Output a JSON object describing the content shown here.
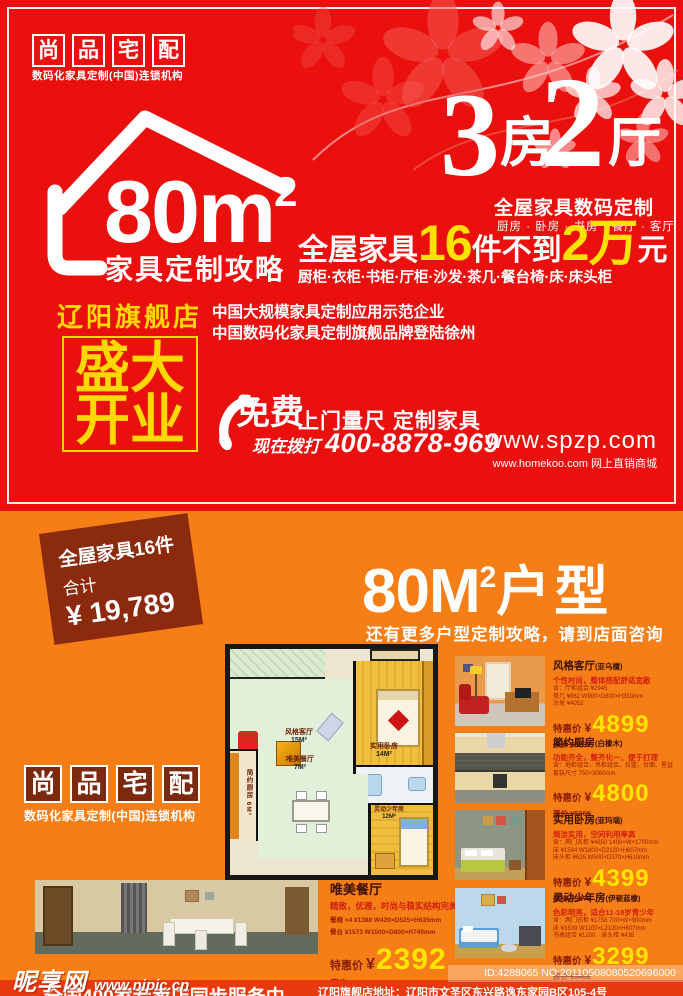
{
  "colors": {
    "red": "#e9100e",
    "orange": "#f57e17",
    "yellow": "#ffe100",
    "ribbon_brown": "#8c2a0e",
    "logo_box_brown": "#7b2a10",
    "gold": "#ffd800"
  },
  "icons": {
    "house": "house-outline-icon",
    "phone": "telephone-handset-icon",
    "flowers": "flower-blossom-decoration"
  },
  "brand": {
    "c0": "尚",
    "c1": "品",
    "c2": "宅",
    "c3": "配",
    "tagline": "数码化家具定制(中国)连锁机构"
  },
  "hero": {
    "area_num": "80m",
    "area_sup": "2",
    "area_caption": "家具定制攻略",
    "big3": "3",
    "fang": "房",
    "big2": "2",
    "ting": "厅",
    "subtitle": "全屋家具数码定制",
    "room_list": "厨房 · 卧房 · 书房 · 餐厅 · 客厅",
    "offer_p1": "全屋家具",
    "offer_n1": "16",
    "offer_p2": "件不到",
    "offer_n2": "2万",
    "offer_p3": "元",
    "furniture_list": "厨柜·衣柜·书柜·厅柜·沙发·茶几·餐台椅·床·床头柜",
    "store_name": "辽阳旗舰店",
    "opening_l1": "盛大",
    "opening_l2": "开业",
    "cred1": "中国大规模家具定制应用示范企业",
    "cred2": "中国数码化家具定制旗舰品牌登陆徐州",
    "cta_free": "免费",
    "cta_rest": "上门量尺 定制家具",
    "call_prefix": "现在拨打",
    "phone": "400-8878-969",
    "site_main": "www.spzp.com",
    "site_sub": "www.homekoo.com 网上直销商城"
  },
  "promo": {
    "ribbon_l1": "全屋家具16件",
    "ribbon_l2": "合计",
    "ribbon_price": "¥ 19,789",
    "title_num": "80M",
    "title_sup": "2",
    "title_suffix": "户型",
    "subtitle": "还有更多户型定制攻略，请到店面咨询"
  },
  "floorplan": {
    "living_name": "风格客厅",
    "living_size": "15M²",
    "bedroom_name": "实用卧房",
    "bedroom_size": "14M²",
    "kitchen_name": "简约厨房 6M²",
    "dining_name": "唯美餐厅",
    "dining_size": "7M²",
    "youth_name": "灵动少年房",
    "youth_size": "12M²"
  },
  "featured": {
    "title": "唯美餐厅",
    "desc": "精致，优雅，时尚与稳实结构完美结合",
    "spec1": "餐椅 ×4 ¥1388 W420×D525×H635mm",
    "spec2": "餐台 ¥1573 W1500×D800×H740mm",
    "price_label": "特惠价",
    "currency": "¥",
    "price": "2392",
    "orig": "原价 ¥2961"
  },
  "products": [
    {
      "title": "风格客厅",
      "variant": "(亚乌檀)",
      "desc": "个性时尚，整体搭配舒适宽敞",
      "spec1": "含：厅柜组合 ¥2945",
      "spec2": "茶几 ¥862 W900×D800×H350mm",
      "spec3": "沙发 ¥4052",
      "price_label": "特惠价",
      "currency": "¥",
      "price": "4899",
      "orig": "原价 ¥5299"
    },
    {
      "title": "简约厨房",
      "variant": "(白橡木)",
      "desc": "功能齐全，整齐化一，便于打理",
      "spec1": "含：地柜组合、吊柜组合、拉篮、台面、星盆",
      "spec2": "套装尺寸 750×3060mm",
      "spec3": "",
      "price_label": "特惠价",
      "currency": "¥",
      "price": "4800",
      "orig": "原价 ¥5365"
    },
    {
      "title": "实用卧房",
      "variant": "(亚玛瑙)",
      "desc": "简洁实用，空间利用率高",
      "spec1": "含：两门衣柜 ¥4650 1400×W×1700mm",
      "spec2": "床 ¥1594 W1800×D2120×H607mm",
      "spec3": "床头柜 ¥635 W500×D370×H610mm",
      "price_label": "特惠价",
      "currency": "¥",
      "price": "4399",
      "orig": "原价 ¥5479"
    },
    {
      "title": "灵动少年房",
      "variant": "(伊顿蓝橡)",
      "desc": "色彩明亮，适合11-18岁青少年",
      "spec1": "含：两门衣柜 ¥1758 700×W×900mm",
      "spec2": "床 ¥1639 W1100×L2120×H607mm",
      "spec3": "书桌组合 ¥1200　床头柜 ¥435",
      "price_label": "特惠价",
      "currency": "¥",
      "price": "3299",
      "orig": "原价 ¥5462"
    }
  ],
  "footer": {
    "watermark": "昵享网",
    "watermark_url": "www.nipic.cn",
    "id_text": "ID:4288065 NO:20110508080520696000",
    "service": "全国400家专卖店同步服务中",
    "address": "辽阳旗舰店地址：辽阳市文圣区东兴路逸东家园B区105-4号"
  }
}
